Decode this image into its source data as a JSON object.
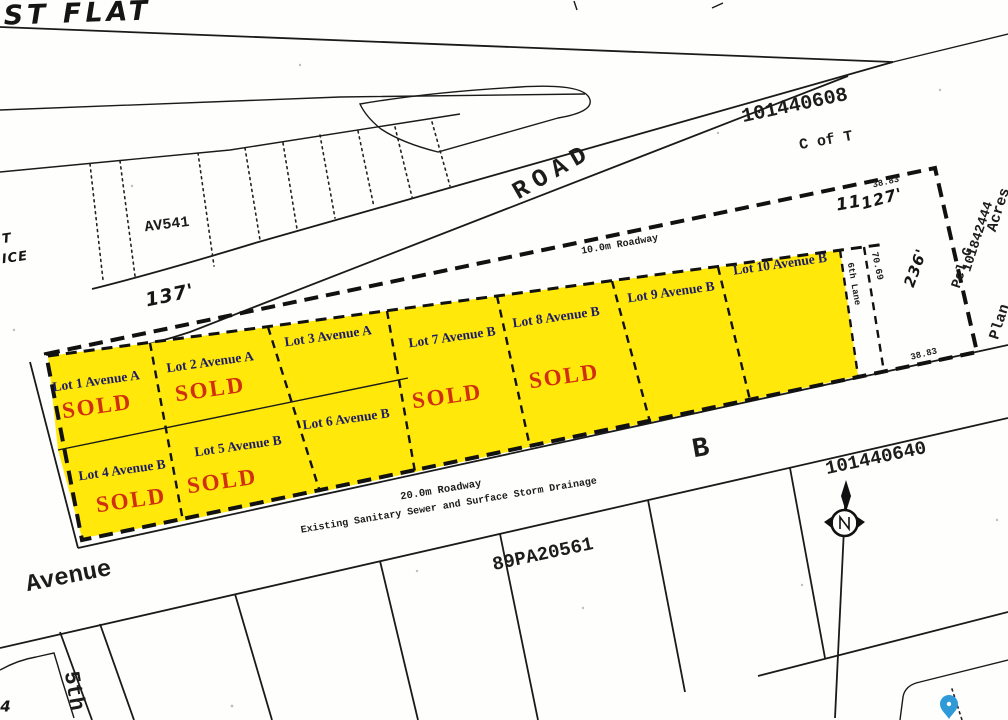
{
  "map": {
    "handwritten": {
      "flat": "AST FLAT",
      "d137": "137'",
      "d127": "127'",
      "d11": "11",
      "scribble": "236'",
      "t": "T",
      "ice": "ICE",
      "corner4": "4"
    },
    "roads": {
      "road": "ROAD",
      "roadway10": "10.0m Roadway",
      "roadway20": "20.0m Roadway",
      "sewer": "Existing Sanitary Sewer and Surface Storm Drainage",
      "avenue": "Avenue",
      "avenue_b": "B",
      "fifth": "5th",
      "lane6": "6th Lane"
    },
    "parcels": {
      "p1": "101440608",
      "cof_t": "C of T",
      "p2": "101440640",
      "p3": "89PA20561",
      "av541": "AV541",
      "pcl_g": "Pcl G",
      "plan_no": "101842444",
      "plan": "Plan",
      "acres": "Acres"
    },
    "measurements": {
      "m3883_top": "38.83",
      "m3883_bottom": "38.83",
      "m7069": "70.69"
    },
    "lots": [
      {
        "name": "Lot 1 Avenue A",
        "status": "SOLD"
      },
      {
        "name": "Lot 2 Avenue A",
        "status": "SOLD"
      },
      {
        "name": "Lot 3 Avenue A",
        "status": ""
      },
      {
        "name": "Lot 4 Avenue B",
        "status": "SOLD"
      },
      {
        "name": "Lot 5 Avenue B",
        "status": "SOLD"
      },
      {
        "name": "Lot 6 Avenue B",
        "status": ""
      },
      {
        "name": "Lot 7 Avenue B",
        "status": "SOLD"
      },
      {
        "name": "Lot 8 Avenue B",
        "status": "SOLD"
      },
      {
        "name": "Lot 9 Avenue B",
        "status": ""
      },
      {
        "name": "Lot 10 Avenue B",
        "status": ""
      }
    ],
    "colors": {
      "lot_fill": "#ffe80a",
      "sold_red": "#d02f10",
      "label_blue": "#1c1c66",
      "pin_blue": "#2f9ad7"
    }
  }
}
